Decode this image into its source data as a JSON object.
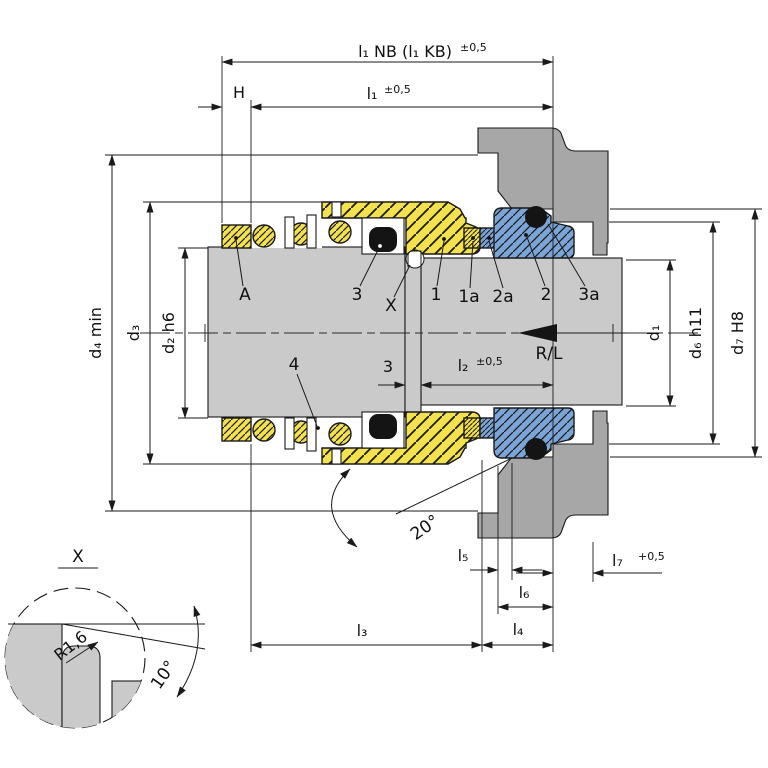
{
  "drawing": {
    "type": "mechanical-seal-installation-drawing",
    "dims_top": {
      "l1nb": "l₁ NB (l₁ KB)",
      "l1nb_tol": "±0,5",
      "l1": "l₁",
      "l1_tol": "±0,5",
      "h": "H"
    },
    "dims_shaft": {
      "snap_ring_width": "3",
      "l2": "l₂",
      "l2_tol": "±0,5"
    },
    "dims_bottom": {
      "l3": "l₃",
      "l4": "l₄",
      "l5": "l₅",
      "l6": "l₆",
      "l7": "l₇",
      "l7_tol": "+0,5"
    },
    "diameters": {
      "d4": "d₄ min",
      "d3": "d₃",
      "d2": "d₂ h6",
      "d1": "d₁",
      "d6": "d₆ h11",
      "d7": "d₇ H8"
    },
    "parts": {
      "collar": "A",
      "oring_shaft": "3",
      "detail_ref": "X",
      "p1": "1",
      "p1a": "1a",
      "p2a": "2a",
      "p2": "2",
      "p3a": "3a",
      "spring": "4"
    },
    "annotations": {
      "rotation": "R/L",
      "angle_20": "20°",
      "angle_10": "10°",
      "radius": "R1,6",
      "detail_title": "X"
    },
    "colors": {
      "rotating_parts_yellow": "#F4E14E",
      "stationary_parts_blue": "#7AA5D6",
      "shaft_gray": "#CACACA",
      "housing_gray": "#A7A7A7",
      "oring_black": "#141414",
      "line": "#1A1A1A"
    }
  }
}
